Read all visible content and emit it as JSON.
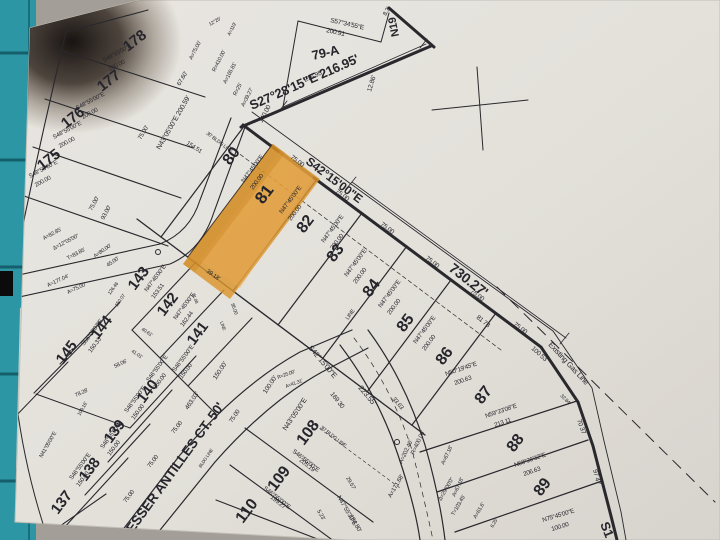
{
  "scene": {
    "desk_color": "#a39f98",
    "mat_color": "#2d96a5",
    "paper_color": "#eceae5",
    "percent_label": "%"
  },
  "map": {
    "type": "plat-survey-map",
    "highlighted_lot": "81",
    "highlight_color": "#e2992b",
    "street_names": [
      "LESSER ANTILLES CT. 50'"
    ],
    "main_road": {
      "bearing": "S42°15'00\"E",
      "length": "730.27'"
    },
    "gas_line_label": "Existing Gas Line",
    "labels": [
      {
        "t": "S57°34'55\"E",
        "x": 330,
        "y": 22,
        "r": 13,
        "s": 6.5
      },
      {
        "t": "200.91",
        "x": 326,
        "y": 32,
        "r": 13,
        "s": 6.5
      },
      {
        "t": "79-A",
        "x": 313,
        "y": 60,
        "r": -13,
        "s": 13,
        "w": "b"
      },
      {
        "t": "216.95'",
        "x": 305,
        "y": 82,
        "r": -24,
        "s": 6.5
      },
      {
        "t": "S27°28'15\"E 216.95'",
        "x": 252,
        "y": 110,
        "r": -24,
        "s": 13,
        "w": "b"
      },
      {
        "t": "12.86'",
        "x": 371,
        "y": 92,
        "r": -73,
        "s": 6.5
      },
      {
        "t": "8.3'",
        "x": 386,
        "y": 16,
        "r": -60,
        "s": 6
      },
      {
        "t": "N19",
        "x": 399,
        "y": 36,
        "r": -101,
        "s": 11,
        "w": "b"
      },
      {
        "t": "A=75.00'",
        "x": 192,
        "y": 60,
        "r": -63,
        "s": 5.5
      },
      {
        "t": "R=410.00'",
        "x": 215,
        "y": 72,
        "r": -63,
        "s": 5.5
      },
      {
        "t": "A=165.81'",
        "x": 226,
        "y": 84,
        "r": -63,
        "s": 5.5
      },
      {
        "t": "R=25'",
        "x": 236,
        "y": 96,
        "r": -63,
        "s": 5.5
      },
      {
        "t": "A=39.27'",
        "x": 244,
        "y": 107,
        "r": -63,
        "s": 5.5
      },
      {
        "t": "140.00",
        "x": 262,
        "y": 123,
        "r": -62,
        "s": 6.5
      },
      {
        "t": "154.51",
        "x": 186,
        "y": 144,
        "r": 33,
        "s": 6
      },
      {
        "t": "12°25'",
        "x": 210,
        "y": 26,
        "r": -30,
        "s": 5
      },
      {
        "t": "A=119'",
        "x": 230,
        "y": 36,
        "r": -63,
        "s": 5
      },
      {
        "t": "178",
        "x": 128,
        "y": 52,
        "r": -38,
        "s": 15,
        "w": "b"
      },
      {
        "t": "177",
        "x": 102,
        "y": 92,
        "r": -38,
        "s": 15,
        "w": "b"
      },
      {
        "t": "176",
        "x": 66,
        "y": 129,
        "r": -38,
        "s": 15,
        "w": "b"
      },
      {
        "t": "175",
        "x": 42,
        "y": 171,
        "r": -38,
        "s": 15,
        "w": "b"
      },
      {
        "t": "S48°55'00\"E",
        "x": 104,
        "y": 62,
        "r": -28,
        "s": 6
      },
      {
        "t": "200.00",
        "x": 110,
        "y": 71,
        "r": -28,
        "s": 6
      },
      {
        "t": "S48°55'00\"E",
        "x": 77,
        "y": 110,
        "r": -28,
        "s": 6
      },
      {
        "t": "200.00",
        "x": 83,
        "y": 119,
        "r": -28,
        "s": 6
      },
      {
        "t": "S48°55'00\"E",
        "x": 54,
        "y": 139,
        "r": -28,
        "s": 6
      },
      {
        "t": "200.00",
        "x": 60,
        "y": 148,
        "r": -28,
        "s": 6
      },
      {
        "t": "S48°55'00\"E",
        "x": 30,
        "y": 178,
        "r": -28,
        "s": 6
      },
      {
        "t": "200.00",
        "x": 36,
        "y": 187,
        "r": -28,
        "s": 6
      },
      {
        "t": "N43°05'00\"E  200.59'",
        "x": 160,
        "y": 150,
        "r": -60,
        "s": 7
      },
      {
        "t": "67.60'",
        "x": 180,
        "y": 86,
        "r": -60,
        "s": 6
      },
      {
        "t": "75.00'",
        "x": 141,
        "y": 140,
        "r": -60,
        "s": 6
      },
      {
        "t": "93.00'",
        "x": 104,
        "y": 220,
        "r": -62,
        "s": 6
      },
      {
        "t": "75.00'",
        "x": 92,
        "y": 211,
        "r": -62,
        "s": 6
      },
      {
        "t": "A=82.85'",
        "x": 44,
        "y": 240,
        "r": -28,
        "s": 5.5
      },
      {
        "t": "Δ=12°05'00\"",
        "x": 54,
        "y": 250,
        "r": -28,
        "s": 5.5
      },
      {
        "t": "T=83.85'",
        "x": 68,
        "y": 260,
        "r": -28,
        "s": 5.5
      },
      {
        "t": "A=80.00'",
        "x": 95,
        "y": 258,
        "r": -35,
        "s": 5.5
      },
      {
        "t": "45.00'",
        "x": 108,
        "y": 267,
        "r": -35,
        "s": 5.5
      },
      {
        "t": "A=177.04'",
        "x": 48,
        "y": 287,
        "r": -25,
        "s": 5.5
      },
      {
        "t": "A=75.00'",
        "x": 68,
        "y": 294,
        "r": -25,
        "s": 5.5
      },
      {
        "t": "80",
        "x": 230,
        "y": 166,
        "r": -53,
        "s": 16,
        "w": "b"
      },
      {
        "t": "81",
        "x": 263,
        "y": 205,
        "r": -53,
        "s": 17,
        "w": "b"
      },
      {
        "t": "82",
        "x": 304,
        "y": 234,
        "r": -53,
        "s": 16,
        "w": "b"
      },
      {
        "t": "83",
        "x": 334,
        "y": 263,
        "r": -53,
        "s": 16,
        "w": "b"
      },
      {
        "t": "84",
        "x": 370,
        "y": 298,
        "r": -53,
        "s": 16,
        "w": "b"
      },
      {
        "t": "85",
        "x": 404,
        "y": 333,
        "r": -53,
        "s": 16,
        "w": "b"
      },
      {
        "t": "86",
        "x": 443,
        "y": 366,
        "r": -53,
        "s": 16,
        "w": "b"
      },
      {
        "t": "S42°15'00\"E",
        "x": 305,
        "y": 163,
        "r": 37,
        "s": 12,
        "w": "b"
      },
      {
        "t": "730.27'",
        "x": 448,
        "y": 270,
        "r": 38,
        "s": 14,
        "w": "b"
      },
      {
        "t": "75.00",
        "x": 290,
        "y": 158,
        "r": 37,
        "s": 6.5
      },
      {
        "t": "75.00",
        "x": 335,
        "y": 192,
        "r": 37,
        "s": 6.5
      },
      {
        "t": "75.00",
        "x": 380,
        "y": 225,
        "r": 37,
        "s": 6.5
      },
      {
        "t": "75.00",
        "x": 425,
        "y": 259,
        "r": 37,
        "s": 6.5
      },
      {
        "t": "75.00",
        "x": 470,
        "y": 292,
        "r": 37,
        "s": 6.5
      },
      {
        "t": "75.00",
        "x": 513,
        "y": 325,
        "r": 37,
        "s": 6.5
      },
      {
        "t": "N47°45'00\"E",
        "x": 244,
        "y": 183,
        "r": -53,
        "s": 6.2
      },
      {
        "t": "200.00",
        "x": 253,
        "y": 190,
        "r": -53,
        "s": 6.2
      },
      {
        "t": "N47°45'00\"E",
        "x": 282,
        "y": 214,
        "r": -53,
        "s": 6.2
      },
      {
        "t": "200.00",
        "x": 291,
        "y": 221,
        "r": -53,
        "s": 6.2
      },
      {
        "t": "N47°45'00\"E",
        "x": 324,
        "y": 243,
        "r": -53,
        "s": 6.2
      },
      {
        "t": "200.00",
        "x": 333,
        "y": 250,
        "r": -53,
        "s": 6.2
      },
      {
        "t": "N47°45'00\"E",
        "x": 347,
        "y": 277,
        "r": -53,
        "s": 6.2
      },
      {
        "t": "200.00",
        "x": 356,
        "y": 284,
        "r": -53,
        "s": 6.2
      },
      {
        "t": "N47°45'00\"E",
        "x": 381,
        "y": 308,
        "r": -53,
        "s": 6.2
      },
      {
        "t": "200.00",
        "x": 390,
        "y": 315,
        "r": -53,
        "s": 6.2
      },
      {
        "t": "N47°45'00\"E",
        "x": 416,
        "y": 344,
        "r": -53,
        "s": 6.2
      },
      {
        "t": "200.00",
        "x": 425,
        "y": 351,
        "r": -53,
        "s": 6.2
      },
      {
        "t": "30' BLDG LINE",
        "x": 206,
        "y": 134,
        "r": 37,
        "s": 5
      },
      {
        "t": "LINE",
        "x": 348,
        "y": 320,
        "r": -53,
        "s": 5.5
      },
      {
        "t": "81 78",
        "x": 476,
        "y": 318,
        "r": 39,
        "s": 6.5
      },
      {
        "t": "100 53",
        "x": 531,
        "y": 349,
        "r": 42,
        "s": 6.5
      },
      {
        "t": "32.84'",
        "x": 560,
        "y": 396,
        "r": 45,
        "s": 5
      },
      {
        "t": "87",
        "x": 482,
        "y": 405,
        "r": -53,
        "s": 16,
        "w": "b"
      },
      {
        "t": "88",
        "x": 514,
        "y": 453,
        "r": -53,
        "s": 16,
        "w": "b"
      },
      {
        "t": "89",
        "x": 541,
        "y": 497,
        "r": -53,
        "s": 16,
        "w": "b"
      },
      {
        "t": "N50°19'45\"E",
        "x": 446,
        "y": 376,
        "r": -19,
        "s": 6.2
      },
      {
        "t": "200.63",
        "x": 455,
        "y": 385,
        "r": -19,
        "s": 6.2
      },
      {
        "t": "N59°23'08\"E",
        "x": 486,
        "y": 418,
        "r": -19,
        "s": 6.2
      },
      {
        "t": "213 11",
        "x": 495,
        "y": 427,
        "r": -19,
        "s": 6.2
      },
      {
        "t": "N68°26'32\"E",
        "x": 515,
        "y": 467,
        "r": -19,
        "s": 6.2
      },
      {
        "t": "206.63",
        "x": 524,
        "y": 476,
        "r": -19,
        "s": 6.2
      },
      {
        "t": "N75°45'00\"E",
        "x": 543,
        "y": 522,
        "r": -17,
        "s": 6.2
      },
      {
        "t": "100.00",
        "x": 552,
        "y": 531,
        "r": -17,
        "s": 6.2
      },
      {
        "t": "70 37",
        "x": 577,
        "y": 420,
        "r": 70,
        "s": 6.5
      },
      {
        "t": "97 47",
        "x": 593,
        "y": 470,
        "r": 75,
        "s": 6.5
      },
      {
        "t": "S1",
        "x": 600,
        "y": 524,
        "r": 68,
        "s": 13,
        "w": "b"
      },
      {
        "t": "Existing Gas Line",
        "x": 548,
        "y": 345,
        "r": 47,
        "s": 7.5
      },
      {
        "t": "S42°15'00\"E",
        "x": 308,
        "y": 348,
        "r": 50,
        "s": 7.5
      },
      {
        "t": "223.55'",
        "x": 358,
        "y": 388,
        "r": 50,
        "s": 7.5
      },
      {
        "t": "33.63",
        "x": 392,
        "y": 399,
        "r": 50,
        "s": 6
      },
      {
        "t": "169 30",
        "x": 330,
        "y": 394,
        "r": 52,
        "s": 6.5
      },
      {
        "t": "R=25.00'",
        "x": 278,
        "y": 379,
        "r": -20,
        "s": 5
      },
      {
        "t": "A=41.31'",
        "x": 286,
        "y": 388,
        "r": -20,
        "s": 5
      },
      {
        "t": "R=400.00'",
        "x": 414,
        "y": 455,
        "r": -65,
        "s": 6
      },
      {
        "t": "A=202.46'",
        "x": 402,
        "y": 464,
        "r": -65,
        "s": 6
      },
      {
        "t": "A=171.68'",
        "x": 391,
        "y": 498,
        "r": -60,
        "s": 6
      },
      {
        "t": "A=67.18'",
        "x": 444,
        "y": 465,
        "r": -65,
        "s": 5.5
      },
      {
        "t": "A=67.18'",
        "x": 455,
        "y": 497,
        "r": -65,
        "s": 5.5
      },
      {
        "t": "Δ=29°00'0\"",
        "x": 441,
        "y": 501,
        "r": -60,
        "s": 5.5
      },
      {
        "t": "T=103.45'",
        "x": 454,
        "y": 516,
        "r": -60,
        "s": 5.5
      },
      {
        "t": "A=61.6'",
        "x": 476,
        "y": 519,
        "r": -60,
        "s": 5.5
      },
      {
        "t": "6.25'",
        "x": 493,
        "y": 528,
        "r": -60,
        "s": 5
      },
      {
        "t": "108",
        "x": 304,
        "y": 446,
        "r": -53,
        "s": 16,
        "w": "b"
      },
      {
        "t": "109",
        "x": 275,
        "y": 492,
        "r": -53,
        "s": 16,
        "w": "b"
      },
      {
        "t": "110",
        "x": 243,
        "y": 524,
        "r": -53,
        "s": 16,
        "w": "b"
      },
      {
        "t": "30' BLDG LINE",
        "x": 320,
        "y": 428,
        "r": 38,
        "s": 5
      },
      {
        "t": "S46°55'00\"E",
        "x": 292,
        "y": 452,
        "r": 38,
        "s": 6.2
      },
      {
        "t": "205.19",
        "x": 299,
        "y": 461,
        "r": 38,
        "s": 6.2
      },
      {
        "t": "S46°55'00\"E",
        "x": 263,
        "y": 489,
        "r": 38,
        "s": 6.2
      },
      {
        "t": "199.27",
        "x": 270,
        "y": 498,
        "r": 38,
        "s": 6.2
      },
      {
        "t": "N47°55'30\"E",
        "x": 337,
        "y": 497,
        "r": 60,
        "s": 6.2
      },
      {
        "t": "184.80'",
        "x": 349,
        "y": 516,
        "r": 60,
        "s": 6.2
      },
      {
        "t": "29.57'",
        "x": 346,
        "y": 478,
        "r": 60,
        "s": 5.5
      },
      {
        "t": "5.23'",
        "x": 317,
        "y": 511,
        "r": 60,
        "s": 5.5
      },
      {
        "t": "LESSER ANTILLES CT. 50'",
        "x": 128,
        "y": 540,
        "r": -54,
        "s": 13.5,
        "w": "b",
        "sp": 3
      },
      {
        "t": "N43°05'00\"E",
        "x": 286,
        "y": 431,
        "r": -56,
        "s": 7
      },
      {
        "t": "463.03'",
        "x": 188,
        "y": 410,
        "r": -56,
        "s": 6.5
      },
      {
        "t": "150.00'",
        "x": 216,
        "y": 380,
        "r": -56,
        "s": 6.5
      },
      {
        "t": "100.00'",
        "x": 266,
        "y": 394,
        "r": -56,
        "s": 6.5
      },
      {
        "t": "75.00",
        "x": 232,
        "y": 423,
        "r": -56,
        "s": 6
      },
      {
        "t": "75.00",
        "x": 174,
        "y": 434,
        "r": -53,
        "s": 6
      },
      {
        "t": "75.00",
        "x": 150,
        "y": 468,
        "r": -53,
        "s": 6
      },
      {
        "t": "75.00",
        "x": 126,
        "y": 503,
        "r": -53,
        "s": 6
      },
      {
        "t": "BLDG LINE",
        "x": 201,
        "y": 468,
        "r": -56,
        "s": 4.5
      },
      {
        "t": "143",
        "x": 135,
        "y": 291,
        "r": -53,
        "s": 15,
        "w": "b"
      },
      {
        "t": "142",
        "x": 164,
        "y": 317,
        "r": -53,
        "s": 15,
        "w": "b"
      },
      {
        "t": "141",
        "x": 194,
        "y": 346,
        "r": -53,
        "s": 15,
        "w": "b"
      },
      {
        "t": "N47°45'00\"E",
        "x": 147,
        "y": 292,
        "r": -53,
        "s": 6
      },
      {
        "t": "153.51",
        "x": 154,
        "y": 299,
        "r": -53,
        "s": 6
      },
      {
        "t": "N47°45'00\"E",
        "x": 176,
        "y": 320,
        "r": -53,
        "s": 6
      },
      {
        "t": "162.44",
        "x": 183,
        "y": 327,
        "r": -53,
        "s": 6
      },
      {
        "t": "S46°55'00\"E",
        "x": 175,
        "y": 372,
        "r": -53,
        "s": 6
      },
      {
        "t": "150.00",
        "x": 182,
        "y": 379,
        "r": -53,
        "s": 6
      },
      {
        "t": "126.46",
        "x": 110,
        "y": 295,
        "r": -53,
        "s": 5
      },
      {
        "t": "150.07",
        "x": 117,
        "y": 307,
        "r": -53,
        "s": 5
      },
      {
        "t": "40.61'",
        "x": 141,
        "y": 330,
        "r": 33,
        "s": 5
      },
      {
        "t": "41.01'",
        "x": 131,
        "y": 352,
        "r": 33,
        "s": 5
      },
      {
        "t": "39.18'",
        "x": 206,
        "y": 272,
        "r": 35,
        "s": 6
      },
      {
        "t": "58.06'",
        "x": 115,
        "y": 368,
        "r": -25,
        "s": 5.5
      },
      {
        "t": "81.08",
        "x": 192,
        "y": 294,
        "r": 70,
        "s": 4.5
      },
      {
        "t": "85.00",
        "x": 231,
        "y": 304,
        "r": 70,
        "s": 5
      },
      {
        "t": "LINE",
        "x": 220,
        "y": 322,
        "r": 70,
        "s": 4.5
      },
      {
        "t": "144",
        "x": 98,
        "y": 340,
        "r": -53,
        "s": 15,
        "w": "b"
      },
      {
        "t": "145",
        "x": 63,
        "y": 365,
        "r": -53,
        "s": 15,
        "w": "b"
      },
      {
        "t": "140",
        "x": 144,
        "y": 404,
        "r": -53,
        "s": 15,
        "w": "b"
      },
      {
        "t": "139",
        "x": 111,
        "y": 444,
        "r": -53,
        "s": 15,
        "w": "b"
      },
      {
        "t": "138",
        "x": 86,
        "y": 482,
        "r": -53,
        "s": 15,
        "w": "b"
      },
      {
        "t": "137",
        "x": 58,
        "y": 515,
        "r": -53,
        "s": 15,
        "w": "b"
      },
      {
        "t": "S56°03'07\"E",
        "x": 84,
        "y": 346,
        "r": -53,
        "s": 6
      },
      {
        "t": "150.33",
        "x": 91,
        "y": 353,
        "r": -53,
        "s": 6
      },
      {
        "t": "S46°55'00\"E",
        "x": 149,
        "y": 382,
        "r": -53,
        "s": 6
      },
      {
        "t": "150.00",
        "x": 156,
        "y": 389,
        "r": -53,
        "s": 6
      },
      {
        "t": "S46°55'00\"E",
        "x": 127,
        "y": 413,
        "r": -53,
        "s": 6
      },
      {
        "t": "150.00",
        "x": 134,
        "y": 420,
        "r": -53,
        "s": 6
      },
      {
        "t": "S46°55'00\"E",
        "x": 103,
        "y": 449,
        "r": -53,
        "s": 6
      },
      {
        "t": "150.00",
        "x": 110,
        "y": 456,
        "r": -53,
        "s": 6
      },
      {
        "t": "S46°55'00\"E",
        "x": 72,
        "y": 480,
        "r": -53,
        "s": 6
      },
      {
        "t": "150.00",
        "x": 79,
        "y": 487,
        "r": -53,
        "s": 6
      },
      {
        "t": "N41°05'00\"E",
        "x": 42,
        "y": 458,
        "r": -60,
        "s": 5.5
      },
      {
        "t": "78.28'",
        "x": 76,
        "y": 397,
        "r": -25,
        "s": 5.5
      },
      {
        "t": "109.16'",
        "x": 80,
        "y": 416,
        "r": -60,
        "s": 5
      },
      {
        "t": "%",
        "x": 4,
        "y": 264,
        "r": 0,
        "s": 10,
        "f": "#f2f2f2"
      }
    ]
  }
}
